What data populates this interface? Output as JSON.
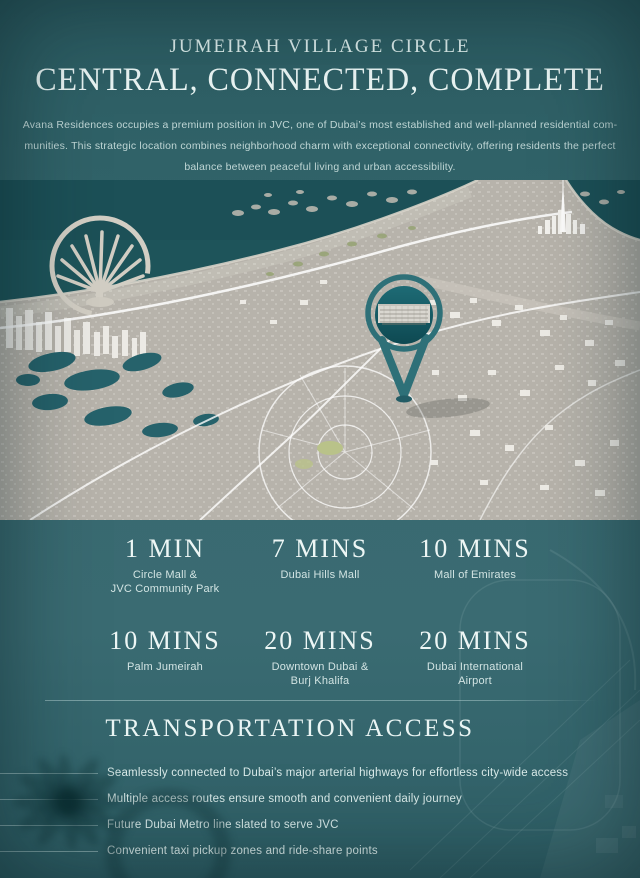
{
  "theme": {
    "background_top": "#2c5c62",
    "background_mid": "#3a6b72",
    "sea": "#1e545a",
    "land": "#b7b3ab",
    "pin": "#2e7078",
    "heading_text": "#eaf5f4",
    "body_text": "#bfd6d5",
    "rule_line": "#b0cecf"
  },
  "header": {
    "subtitle": "JUMEIRAH VILLAGE CIRCLE",
    "title": "CENTRAL, CONNECTED, COMPLETE",
    "description_lines": [
      "Avana Residences occupies a premium position in JVC, one of Dubai’s most established and well-planned residential com-",
      "munities. This strategic location combines neighborhood charm with exceptional connectivity, offering residents the perfect",
      "balance between peaceful living and urban accessibility."
    ]
  },
  "distances": {
    "items": [
      {
        "time": "1 MIN",
        "place": "Circle Mall &\nJVC Community Park"
      },
      {
        "time": "7 MINS",
        "place": "Dubai Hills Mall"
      },
      {
        "time": "10 MINS",
        "place": "Mall of Emirates"
      },
      {
        "time": "10 MINS",
        "place": "Palm Jumeirah"
      },
      {
        "time": "20 MINS",
        "place": "Downtown Dubai &\nBurj Khalifa"
      },
      {
        "time": "20 MINS",
        "place": "Dubai International\nAirport"
      }
    ]
  },
  "transport": {
    "title": "TRANSPORTATION ACCESS",
    "items": [
      "Seamlessly connected to Dubai’s major arterial highways for effortless city-wide access",
      "Multiple access routes ensure smooth and convenient daily journey",
      "Future Dubai Metro line slated to serve JVC",
      "Convenient taxi pickup zones and ride-share points"
    ]
  }
}
